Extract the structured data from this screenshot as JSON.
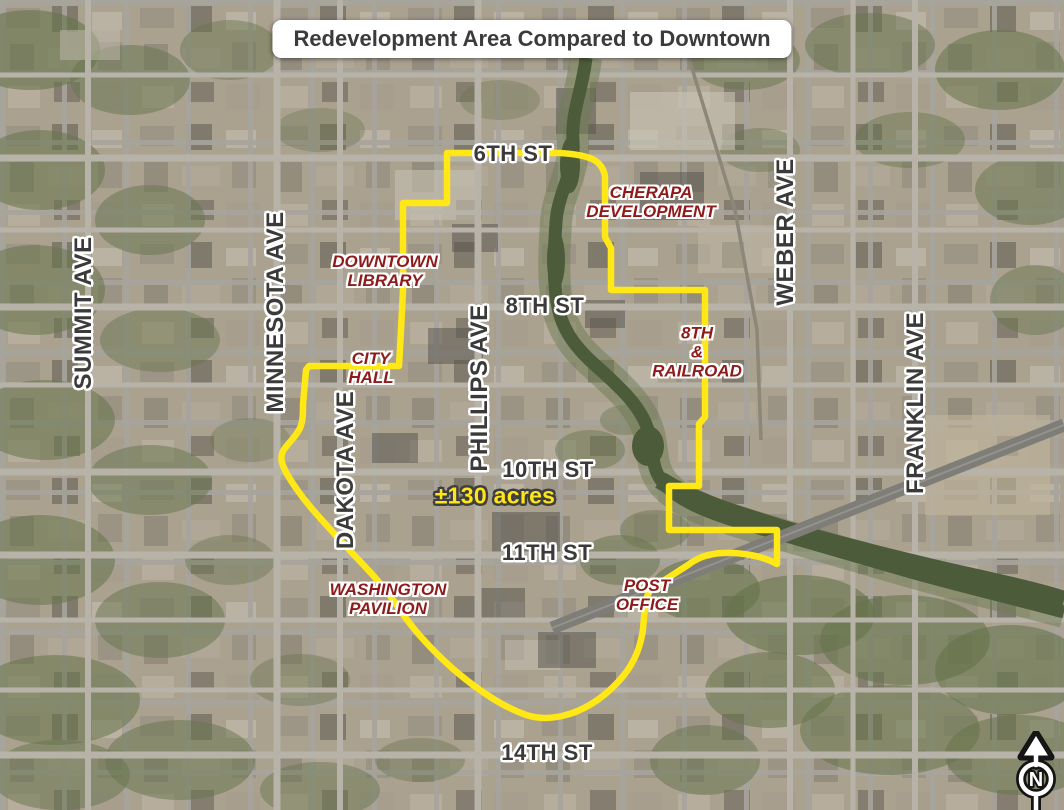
{
  "title": "Redevelopment Area Compared to Downtown",
  "map": {
    "streets": [
      {
        "text": "6TH ST"
      },
      {
        "text": "8TH ST"
      },
      {
        "text": "10TH ST"
      },
      {
        "text": "11TH ST"
      },
      {
        "text": "14TH ST"
      }
    ],
    "avenues": [
      {
        "text": "SUMMIT AVE"
      },
      {
        "text": "MINNESOTA AVE"
      },
      {
        "text": "DAKOTA AVE"
      },
      {
        "text": "PHILLIPS AVE"
      },
      {
        "text": "WEBER AVE"
      },
      {
        "text": "FRANKLIN AVE"
      }
    ],
    "landmarks": [
      {
        "id": "downtown-library",
        "lines": [
          "DOWNTOWN",
          "LIBRARY"
        ]
      },
      {
        "id": "city-hall",
        "lines": [
          "CITY",
          "HALL"
        ]
      },
      {
        "id": "cherapa-development",
        "lines": [
          "CHERAPA",
          "DEVELOPMENT"
        ]
      },
      {
        "id": "8th-and-railroad",
        "lines": [
          "8TH",
          "&",
          "RAILROAD"
        ]
      },
      {
        "id": "washington-pavilion",
        "lines": [
          "WASHINGTON",
          "PAVILION"
        ]
      },
      {
        "id": "post-office",
        "lines": [
          "POST",
          "OFFICE"
        ]
      }
    ],
    "area_measurement": "±130 acres",
    "north_indicator": "N",
    "boundary_color": "#ffe816",
    "label_colors": {
      "street": "#3a3a3a",
      "landmark": "#8e1b1b",
      "area": "#ffe61a"
    }
  }
}
